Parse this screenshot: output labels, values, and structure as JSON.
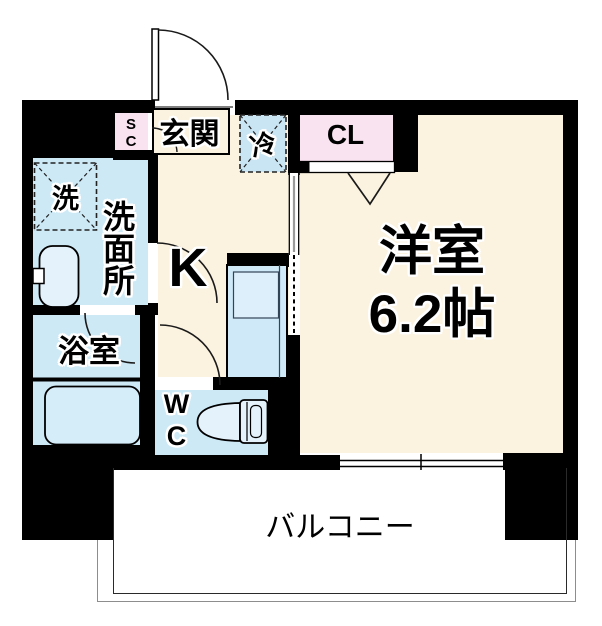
{
  "colors": {
    "floor_cream": "#FBF2DF",
    "wet_area_blue": "#CDE9F6",
    "closet_pink": "#F9E3F0",
    "wall_black": "#000000",
    "fixture_blue": "#E4F2FB",
    "counter_blue": "#CFE9F8"
  },
  "rooms": {
    "genkan": {
      "label": "玄関"
    },
    "shoe_closet": {
      "label": "SC"
    },
    "fridge": {
      "label": "冷"
    },
    "closet": {
      "label": "CL"
    },
    "western_room": {
      "label": "洋室",
      "size": "6.2帖"
    },
    "kitchen": {
      "label": "K"
    },
    "washroom": {
      "label": "洗面所"
    },
    "washer": {
      "label": "洗"
    },
    "bathroom": {
      "label": "浴室"
    },
    "wc": {
      "label": "WC"
    },
    "balcony": {
      "label": "バルコニー"
    }
  }
}
